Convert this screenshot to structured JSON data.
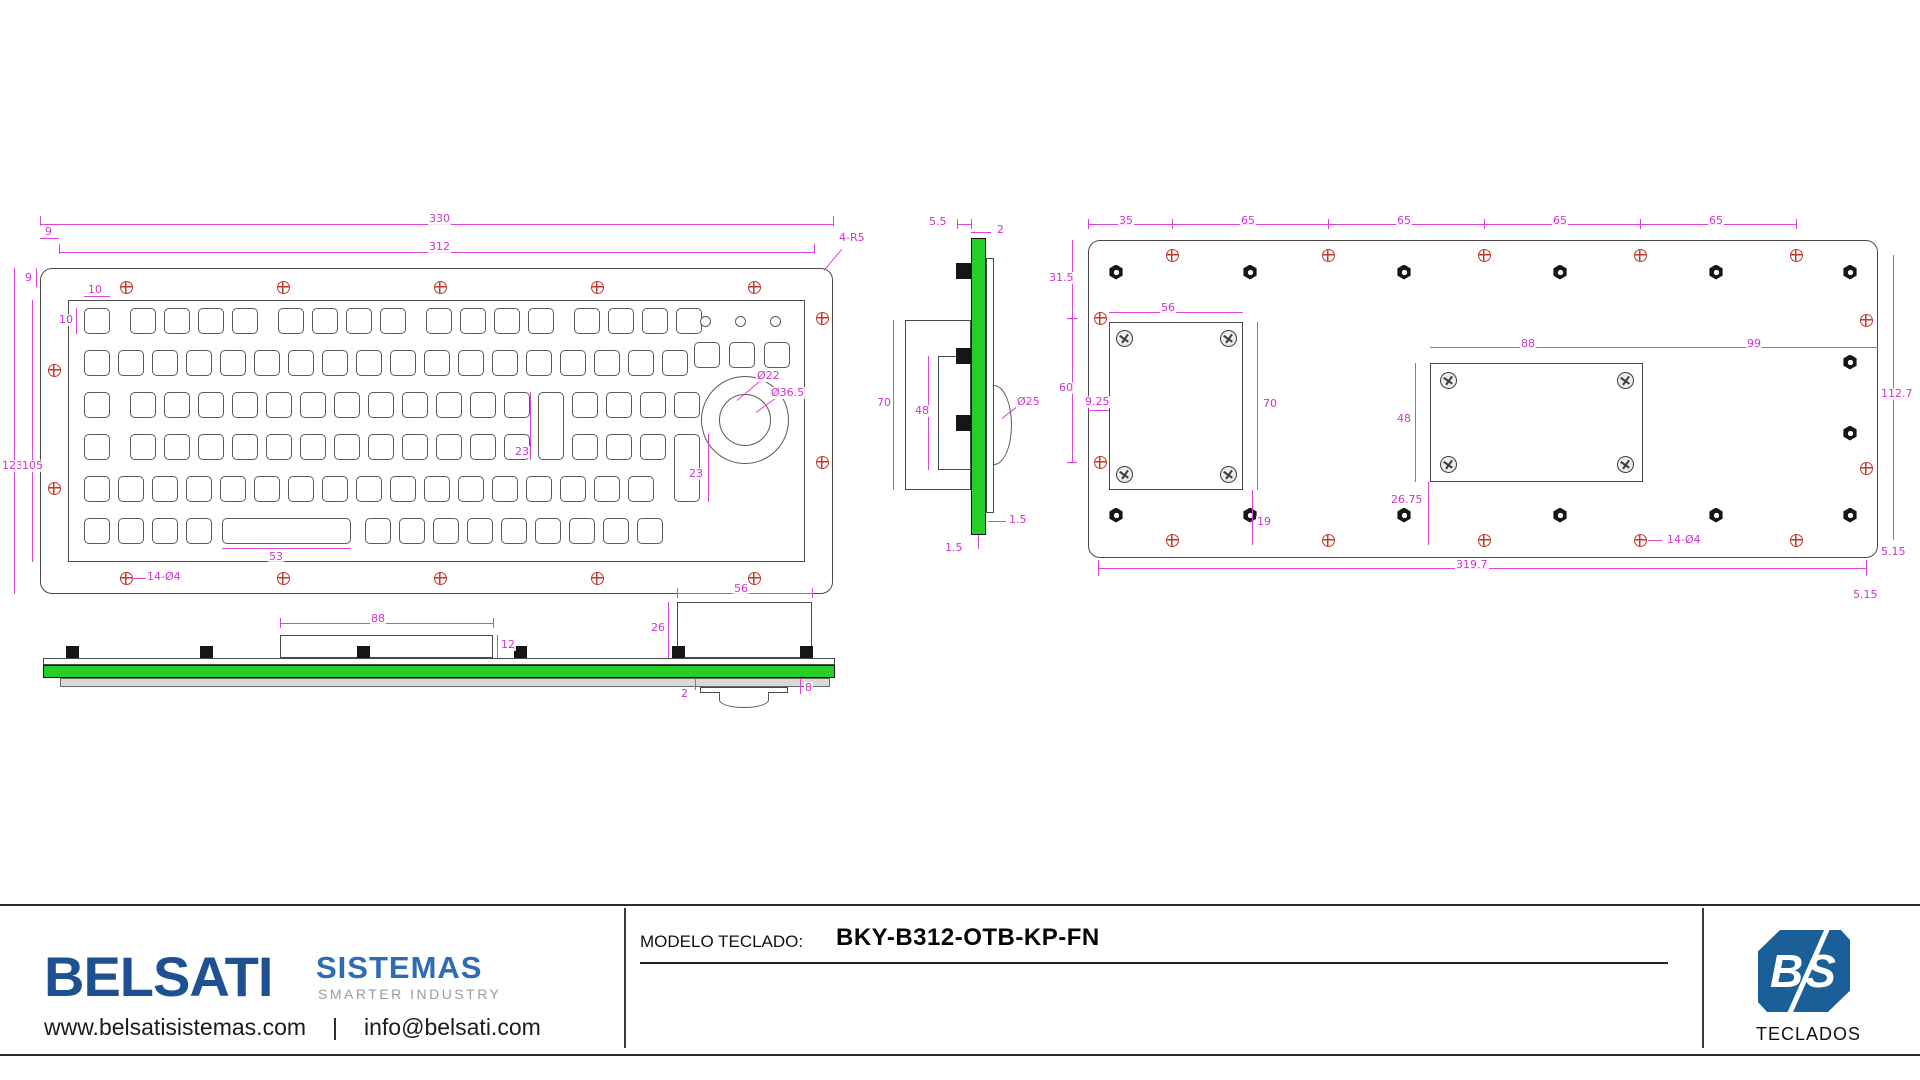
{
  "colors": {
    "magenta": "#d944d9",
    "pcb_green": "#25cf25",
    "hole_red": "#c0392b",
    "line_gray": "#4a4a4a",
    "brand_navy": "#1d5192",
    "brand_blue": "#2e6db4",
    "tagline_gray": "#9b9b9b",
    "logo_blue": "#1a5f97"
  },
  "views": {
    "front": {
      "boxes": [
        [
          40,
          268,
          793,
          326,
          12
        ],
        [
          68,
          300,
          737,
          262,
          0
        ]
      ],
      "key_rows": [
        {
          "y": 308,
          "xs": [
            84,
            130,
            164,
            198,
            232,
            278,
            312,
            346,
            380,
            426,
            460,
            494,
            528,
            574,
            608,
            642,
            676
          ]
        },
        {
          "y": 350,
          "xs": [
            84,
            118,
            152,
            186,
            220,
            254,
            288,
            322,
            356,
            390,
            424,
            458,
            492,
            526,
            560,
            594,
            628,
            662
          ]
        },
        {
          "y": 392,
          "xs": [
            84,
            130,
            164,
            198,
            232,
            266,
            300,
            334,
            368,
            402,
            436,
            470,
            504,
            572,
            606,
            640,
            674
          ]
        },
        {
          "y": 434,
          "xs": [
            84,
            130,
            164,
            198,
            232,
            266,
            300,
            334,
            368,
            402,
            436,
            470,
            504,
            572,
            606,
            640
          ]
        },
        {
          "y": 476,
          "xs": [
            84,
            118,
            152,
            186,
            220,
            254,
            288,
            322,
            356,
            390,
            424,
            458,
            492,
            526,
            560,
            594,
            628
          ]
        },
        {
          "y": 518,
          "xs": [
            84,
            118,
            152,
            186,
            365,
            399,
            433,
            467,
            501,
            535,
            569,
            603,
            637
          ]
        }
      ],
      "key_extra": [
        [
          538,
          392,
          26,
          68
        ],
        [
          674,
          434,
          26,
          68
        ],
        [
          222,
          518,
          129,
          26
        ]
      ],
      "buttons": [
        [
          694,
          342
        ],
        [
          729,
          342
        ],
        [
          764,
          342
        ]
      ],
      "circles": [
        [
          745,
          420,
          44
        ],
        [
          745,
          420,
          26
        ]
      ],
      "leds": [
        [
          705,
          321
        ],
        [
          740,
          321
        ],
        [
          775,
          321
        ]
      ],
      "holes": [
        [
          126,
          287
        ],
        [
          283,
          287
        ],
        [
          440,
          287
        ],
        [
          597,
          287
        ],
        [
          754,
          287
        ],
        [
          126,
          578
        ],
        [
          283,
          578
        ],
        [
          440,
          578
        ],
        [
          597,
          578
        ],
        [
          754,
          578
        ],
        [
          54,
          370
        ],
        [
          54,
          488
        ],
        [
          822,
          318
        ],
        [
          822,
          462
        ]
      ],
      "mlines": [
        [
          40,
          224,
          793,
          1
        ],
        [
          59,
          252,
          755,
          1
        ],
        [
          14,
          268,
          1,
          326
        ],
        [
          32,
          300,
          1,
          262
        ],
        [
          222,
          548,
          129,
          1
        ],
        [
          84,
          296,
          26,
          1
        ],
        [
          76,
          308,
          1,
          26
        ],
        [
          530,
          392,
          1,
          68
        ],
        [
          708,
          434,
          1,
          68
        ],
        [
          132,
          578,
          14,
          1
        ],
        [
          40,
          238,
          19,
          1
        ],
        [
          36,
          268,
          1,
          19
        ],
        [
          40,
          216,
          1,
          10
        ],
        [
          833,
          216,
          1,
          10
        ],
        [
          59,
          244,
          1,
          10
        ],
        [
          814,
          244,
          1,
          10
        ]
      ],
      "rlines": [
        [
          824,
          270,
          28,
          -50
        ],
        [
          737,
          400,
          32,
          -40
        ],
        [
          756,
          412,
          36,
          -36
        ]
      ],
      "dims": [
        [
          "330",
          428,
          213
        ],
        [
          "312",
          428,
          241
        ],
        [
          "9",
          44,
          226
        ],
        [
          "9",
          24,
          272
        ],
        [
          "123",
          1,
          460
        ],
        [
          "105",
          21,
          460
        ],
        [
          "10",
          87,
          284
        ],
        [
          "10",
          58,
          314
        ],
        [
          "23",
          514,
          446
        ],
        [
          "23",
          688,
          468
        ],
        [
          "53",
          268,
          551
        ],
        [
          "14-Ø4",
          146,
          571
        ],
        [
          "Ø22",
          756,
          370
        ],
        [
          "Ø36.5",
          770,
          387
        ],
        [
          "4-R5",
          838,
          232
        ]
      ]
    },
    "side": {
      "boxes": [
        [
          905,
          320,
          66,
          170,
          0
        ],
        [
          938,
          356,
          33,
          114,
          0
        ],
        [
          986,
          258,
          8,
          255,
          0
        ]
      ],
      "green": [
        [
          971,
          238,
          15,
          297
        ]
      ],
      "domeR": [
        [
          994,
          385,
          18,
          80
        ]
      ],
      "clips": [
        [
          956,
          263,
          15,
          16
        ],
        [
          956,
          348,
          15,
          16
        ],
        [
          956,
          415,
          15,
          16
        ]
      ],
      "mlines": [
        [
          957,
          224,
          14,
          1
        ],
        [
          971,
          232,
          20,
          1
        ],
        [
          893,
          320,
          1,
          170
        ],
        [
          928,
          356,
          1,
          114
        ],
        [
          988,
          521,
          18,
          1
        ],
        [
          978,
          535,
          1,
          14
        ],
        [
          957,
          219,
          1,
          10
        ],
        [
          971,
          219,
          1,
          10
        ]
      ],
      "rlines": [
        [
          1002,
          418,
          18,
          -38
        ]
      ],
      "dims": [
        [
          "5.5",
          928,
          216
        ],
        [
          "2",
          996,
          224
        ],
        [
          "70",
          876,
          397
        ],
        [
          "48",
          914,
          405
        ],
        [
          "Ø25",
          1016,
          396
        ],
        [
          "1.5",
          1008,
          514
        ],
        [
          "1.5",
          944,
          542
        ]
      ]
    },
    "back": {
      "boxes": [
        [
          1088,
          240,
          790,
          318,
          12
        ],
        [
          1109,
          322,
          134,
          168,
          0
        ],
        [
          1430,
          363,
          213,
          119,
          0
        ]
      ],
      "holes": [
        [
          1172,
          255
        ],
        [
          1328,
          255
        ],
        [
          1484,
          255
        ],
        [
          1640,
          255
        ],
        [
          1796,
          255
        ],
        [
          1172,
          540
        ],
        [
          1328,
          540
        ],
        [
          1484,
          540
        ],
        [
          1640,
          540
        ],
        [
          1796,
          540
        ],
        [
          1100,
          318
        ],
        [
          1100,
          462
        ],
        [
          1866,
          320
        ],
        [
          1866,
          468
        ]
      ],
      "nuts": [
        [
          1116,
          272
        ],
        [
          1250,
          272
        ],
        [
          1404,
          272
        ],
        [
          1560,
          272
        ],
        [
          1716,
          272
        ],
        [
          1850,
          272
        ],
        [
          1116,
          515
        ],
        [
          1250,
          515
        ],
        [
          1404,
          515
        ],
        [
          1560,
          515
        ],
        [
          1716,
          515
        ],
        [
          1850,
          515
        ],
        [
          1850,
          362
        ],
        [
          1850,
          433
        ]
      ],
      "screws": [
        [
          1124,
          338
        ],
        [
          1228,
          338
        ],
        [
          1124,
          474
        ],
        [
          1228,
          474
        ],
        [
          1448,
          380
        ],
        [
          1625,
          380
        ],
        [
          1448,
          464
        ],
        [
          1625,
          464
        ]
      ],
      "mlines": [
        [
          1088,
          224,
          708,
          1
        ],
        [
          1088,
          219,
          1,
          10
        ],
        [
          1172,
          219,
          1,
          10
        ],
        [
          1328,
          219,
          1,
          10
        ],
        [
          1484,
          219,
          1,
          10
        ],
        [
          1640,
          219,
          1,
          10
        ],
        [
          1796,
          219,
          1,
          10
        ],
        [
          1072,
          240,
          1,
          222
        ],
        [
          1067,
          318,
          10,
          1
        ],
        [
          1067,
          462,
          10,
          1
        ],
        [
          1088,
          410,
          21,
          1
        ],
        [
          1109,
          312,
          134,
          1
        ],
        [
          1257,
          322,
          1,
          168
        ],
        [
          1430,
          347,
          448,
          1
        ],
        [
          1415,
          363,
          1,
          119
        ],
        [
          1893,
          255,
          1,
          285
        ],
        [
          1428,
          482,
          1,
          63
        ],
        [
          1252,
          490,
          1,
          55
        ],
        [
          1098,
          568,
          768,
          1
        ],
        [
          1648,
          540,
          14,
          1
        ],
        [
          1098,
          560,
          1,
          16
        ],
        [
          1866,
          560,
          1,
          16
        ]
      ],
      "rlines": [],
      "dims": [
        [
          "35",
          1118,
          215
        ],
        [
          "65",
          1240,
          215
        ],
        [
          "65",
          1396,
          215
        ],
        [
          "65",
          1552,
          215
        ],
        [
          "65",
          1708,
          215
        ],
        [
          "31.5",
          1048,
          272
        ],
        [
          "60",
          1058,
          382
        ],
        [
          "9.25",
          1084,
          396
        ],
        [
          "56",
          1160,
          302
        ],
        [
          "70",
          1262,
          398
        ],
        [
          "88",
          1520,
          338
        ],
        [
          "99",
          1746,
          338
        ],
        [
          "48",
          1396,
          413
        ],
        [
          "112.7",
          1880,
          388
        ],
        [
          "26.75",
          1390,
          494
        ],
        [
          "19",
          1256,
          516
        ],
        [
          "319.7",
          1455,
          559
        ],
        [
          "5.15",
          1880,
          546
        ],
        [
          "5.15",
          1852,
          589
        ],
        [
          "14-Ø4",
          1666,
          534
        ]
      ]
    },
    "bottom": {
      "boxes": [
        [
          43,
          658,
          792,
          7,
          0
        ],
        [
          280,
          635,
          213,
          23,
          0
        ],
        [
          677,
          602,
          135,
          56,
          0
        ],
        [
          700,
          687,
          88,
          6,
          0
        ]
      ],
      "graybar": [
        [
          60,
          678,
          770,
          9
        ]
      ],
      "green": [
        [
          43,
          665,
          792,
          13
        ]
      ],
      "domeD": [
        [
          719,
          692,
          50,
          16
        ]
      ],
      "clips": [
        [
          66,
          646,
          13,
          12
        ],
        [
          200,
          646,
          13,
          12
        ],
        [
          357,
          646,
          13,
          12
        ],
        [
          514,
          646,
          13,
          12
        ],
        [
          672,
          646,
          13,
          12
        ],
        [
          800,
          646,
          13,
          12
        ]
      ],
      "mlines": [
        [
          280,
          623,
          213,
          1
        ],
        [
          677,
          593,
          135,
          1
        ],
        [
          668,
          602,
          1,
          56
        ],
        [
          497,
          635,
          1,
          23
        ],
        [
          695,
          678,
          1,
          12
        ],
        [
          800,
          678,
          1,
          16
        ],
        [
          280,
          618,
          1,
          10
        ],
        [
          493,
          618,
          1,
          10
        ],
        [
          677,
          588,
          1,
          10
        ],
        [
          812,
          588,
          1,
          10
        ]
      ],
      "rlines": [],
      "dims": [
        [
          "88",
          370,
          613
        ],
        [
          "12",
          500,
          639
        ],
        [
          "56",
          733,
          583
        ],
        [
          "26",
          650,
          622
        ],
        [
          "2",
          680,
          688
        ],
        [
          "8",
          804,
          682
        ]
      ]
    }
  },
  "footer": {
    "brand": "BELSATI",
    "brand2": "SISTEMAS",
    "tagline": "SMARTER INDUSTRY",
    "website": "www.belsatisistemas.com",
    "sep": "|",
    "email": "info@belsati.com",
    "model_label": "MODELO TECLADO:",
    "model_value": "BKY-B312-OTB-KP-FN",
    "logo_text": "BS",
    "logo_caption": "TECLADOS"
  }
}
